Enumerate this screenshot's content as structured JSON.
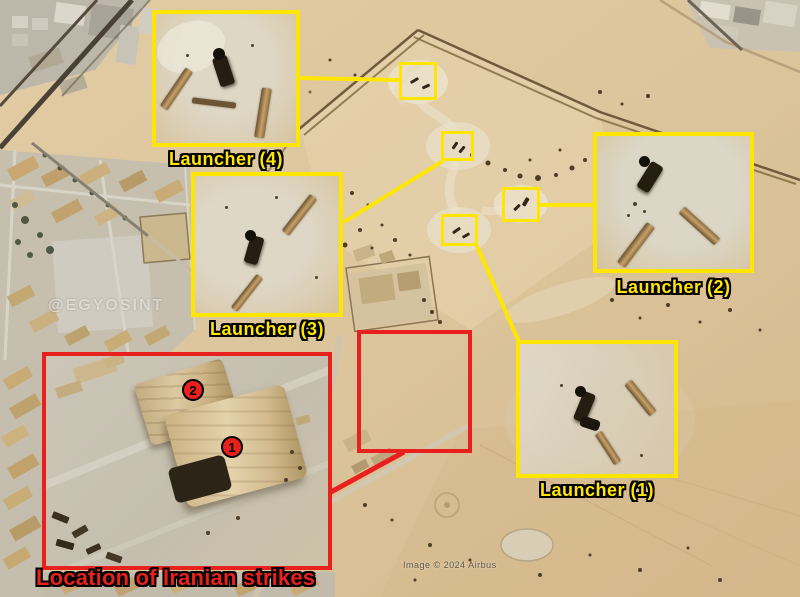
{
  "annotations": {
    "launchers": [
      {
        "number": "1",
        "label": "Launcher (1)"
      },
      {
        "number": "2",
        "label": "Launcher (2)"
      },
      {
        "number": "3",
        "label": "Launcher (3)"
      },
      {
        "number": "4",
        "label": "Launcher (4)"
      }
    ],
    "strike_area": {
      "label": "Location of Iranian strikes",
      "markers": [
        {
          "number": "1"
        },
        {
          "number": "2"
        }
      ]
    }
  },
  "watermarks": {
    "source_account": "@EGYOSINT",
    "imagery_credit": "Image © 2024 Airbus"
  },
  "colors": {
    "highlight_yellow": "#ffe600",
    "alert_red": "#e8201e",
    "label_outline": "#000000"
  }
}
